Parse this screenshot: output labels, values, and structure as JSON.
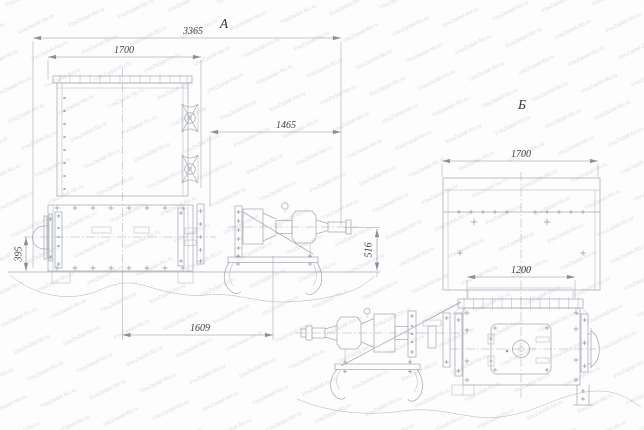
{
  "drawing": {
    "watermark_text": "VseZadali-No.ru",
    "views": [
      {
        "label": "A",
        "dimensions": {
          "overall_length": "3365",
          "box_width": "1700",
          "upper_offset": "1465",
          "axis_height": "516",
          "left_axis_height": "395",
          "base_span": "1609"
        }
      },
      {
        "label": "Б",
        "dimensions": {
          "body_width": "1700",
          "outlet_width": "1200"
        }
      }
    ]
  }
}
